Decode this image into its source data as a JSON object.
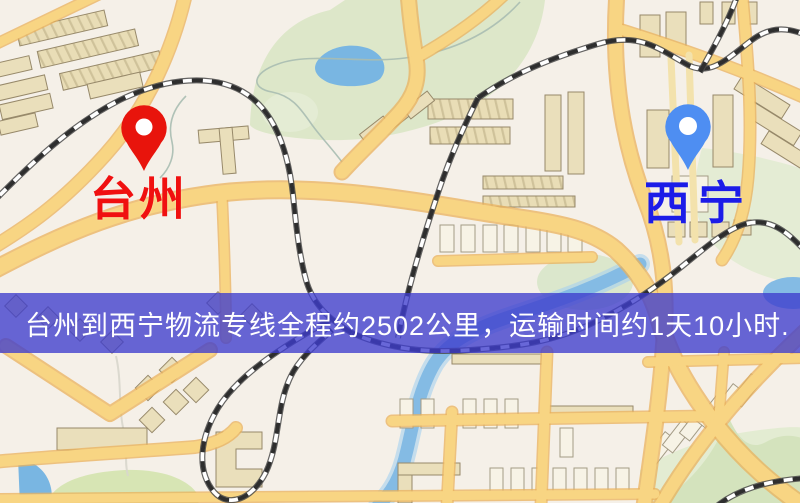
{
  "origin": {
    "label": "台州",
    "pin_color": "#e8140c",
    "label_color": "#f01010"
  },
  "destination": {
    "label": "西宁",
    "pin_color": "#4e8ef2",
    "label_color": "#1c1ce8"
  },
  "banner": {
    "text": "台州到西宁物流专线全程约2502公里，运输时间约1天10小时.",
    "background_color": "rgba(62,60,205,0.78)",
    "text_color": "#ffffff"
  },
  "route": {
    "from": "台州",
    "to": "西宁",
    "distance_text": "约2502公里",
    "duration_text": "约1天10小时"
  },
  "icons": {
    "origin_pin": "map-pin-icon",
    "destination_pin": "map-pin-icon"
  },
  "colors": {
    "map_background": "#f5f0e8",
    "road": "#f8d583",
    "road_casing": "#eab25c",
    "green_area": "#dde7c9",
    "water": "#79b6e2",
    "building": "#eadfbb",
    "railway": "#2e2e2e"
  }
}
